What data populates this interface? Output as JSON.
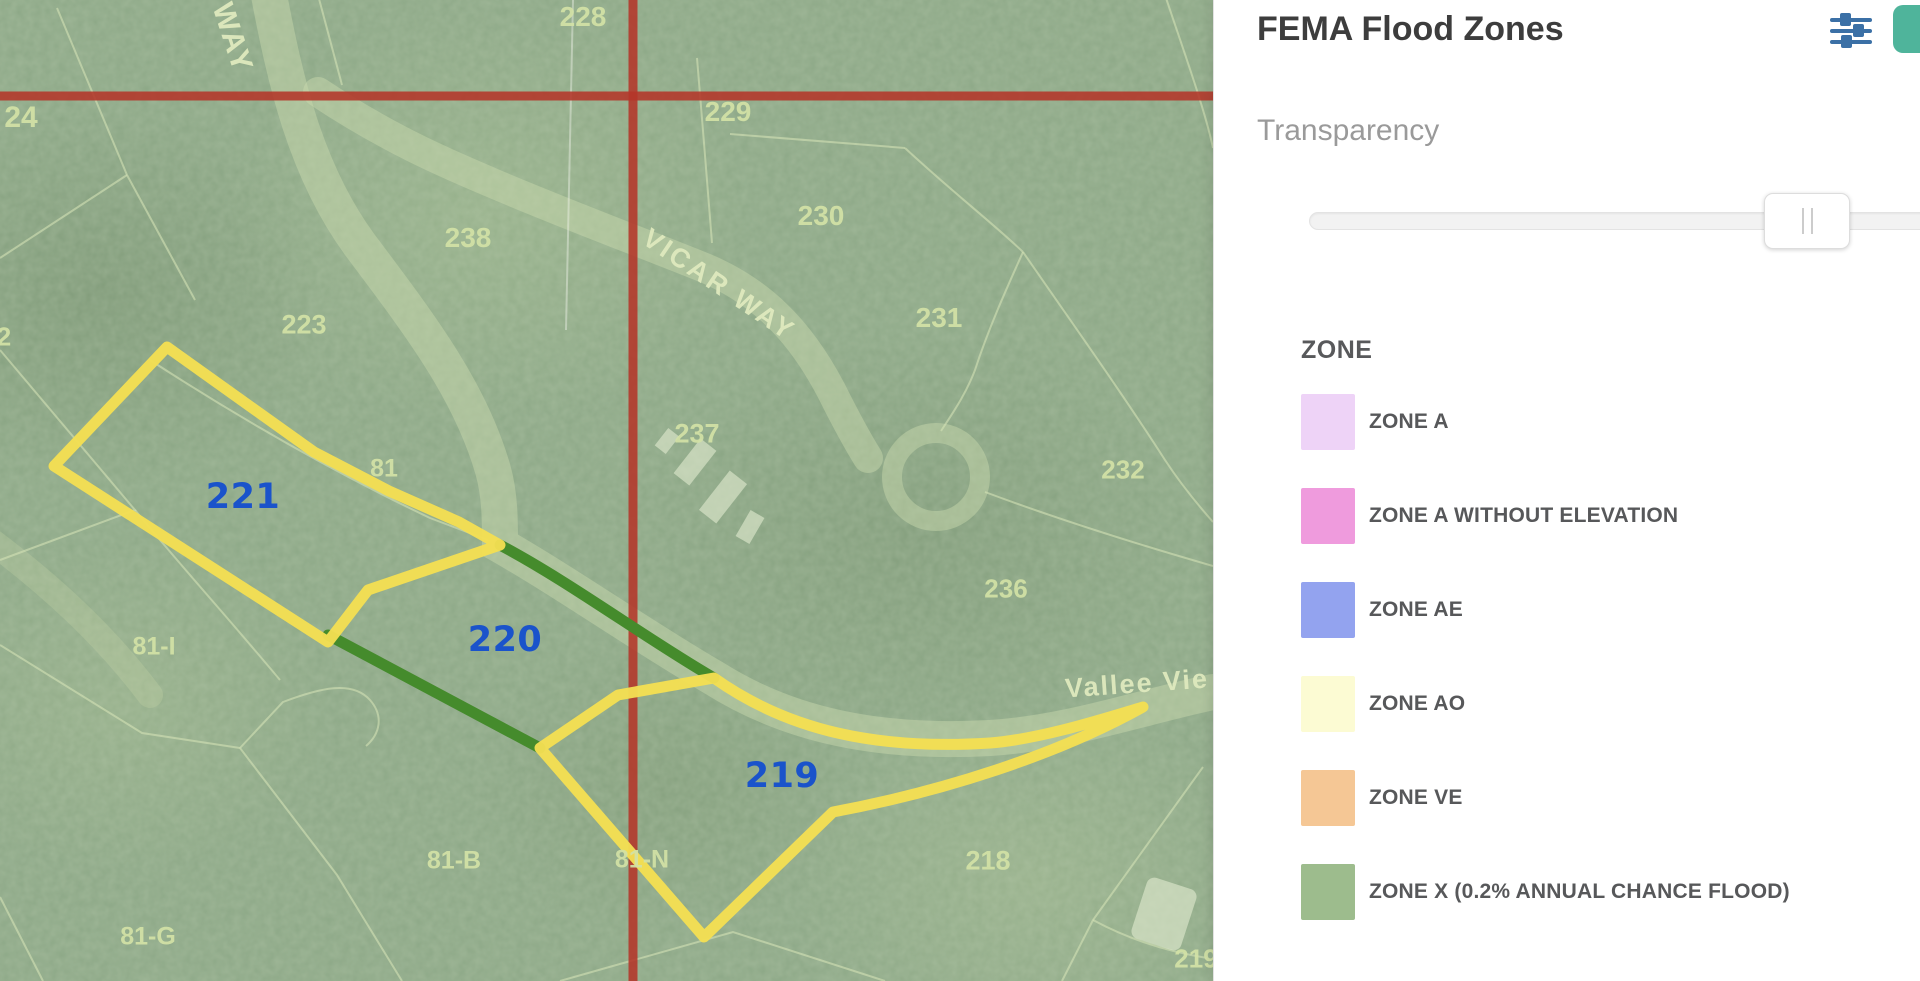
{
  "theme": {
    "grid_red": "#b43529",
    "boundary_green": "#458b2c",
    "highlight_yellow": "#f4df52",
    "label_blue": "#1a53cb",
    "panel_teal": "#4fb49b",
    "icon_blue": "#3b70a6",
    "label_olive": "#d3e2a6"
  },
  "panel": {
    "title": "FEMA Flood Zones",
    "transparency_label": "Transparency",
    "slider_value_percent": 75,
    "legend": {
      "header": "ZONE",
      "items": [
        {
          "label": "ZONE A",
          "color": "#eed3f7"
        },
        {
          "label": "ZONE A WITHOUT ELEVATION",
          "color": "#ef9bdd"
        },
        {
          "label": "ZONE AE",
          "color": "#93a3ef"
        },
        {
          "label": "ZONE AO",
          "color": "#fcfbd3"
        },
        {
          "label": "ZONE VE",
          "color": "#f5c795"
        },
        {
          "label": "ZONE X (0.2% ANNUAL CHANCE FLOOD)",
          "color": "#9dbc8d"
        }
      ]
    },
    "icons": {
      "filter": "sliders-icon",
      "action": "panel-action-button"
    }
  },
  "map": {
    "highlighted_parcels": [
      "219",
      "220",
      "221"
    ],
    "labels": {
      "n2": "2",
      "n24": "24",
      "n81": "81",
      "n81i": "81-I",
      "n81b": "81-B",
      "n81n": "81-N",
      "n81g": "81-G",
      "n218": "218",
      "n219b": "219",
      "n223": "223",
      "n228": "228",
      "n229": "229",
      "n230": "230",
      "n231": "231",
      "n232": "232",
      "n236": "236",
      "n237": "237",
      "n238": "238",
      "p219": "219",
      "p220": "220",
      "p221": "221"
    },
    "streets": {
      "way": "WAY",
      "vicar": "VICAR WAY",
      "vallee": "Vallee Vie"
    }
  }
}
